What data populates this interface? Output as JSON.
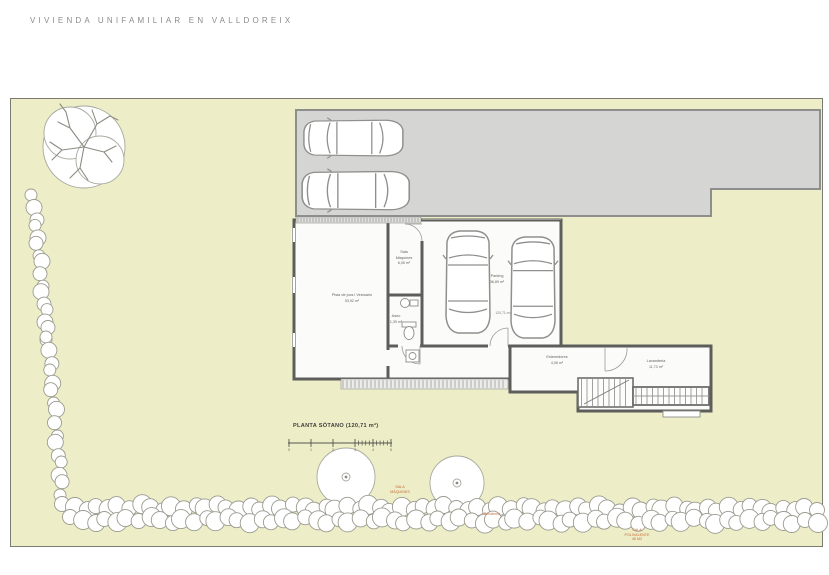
{
  "title": "VIVIENDA UNIFAMILIAR EN VALLDOREIX",
  "plan": {
    "caption": "PLANTA SÓTANO (120,71 m²)",
    "rooms": [
      {
        "name": "Pista de jocs i Vestuario",
        "area": "53,92 m²"
      },
      {
        "name": "Sala Màquines",
        "area": "6,05 m²"
      },
      {
        "name": "Parking",
        "area": "36,89 m²"
      },
      {
        "name": "Aseo",
        "area": "1,39 m²"
      },
      {
        "name": "Estenedores",
        "area": "4,06 m²"
      },
      {
        "name": "Lavanderia",
        "area": "11,73 m²"
      }
    ],
    "area_note": "120,71 m²",
    "scale_ticks": [
      "0",
      "1",
      "2",
      "3",
      "4",
      "5"
    ]
  },
  "site_notes": [
    {
      "text": "SALA MÀQUINES"
    },
    {
      "text": "Pendiente"
    },
    {
      "text": "SALA POLIVALENTE 46 M2"
    }
  ],
  "colors": {
    "garden": "#edeec8",
    "driveway": "#d5d5d3",
    "wall": "#5d5d5c",
    "accent_note": "#c46a38"
  }
}
